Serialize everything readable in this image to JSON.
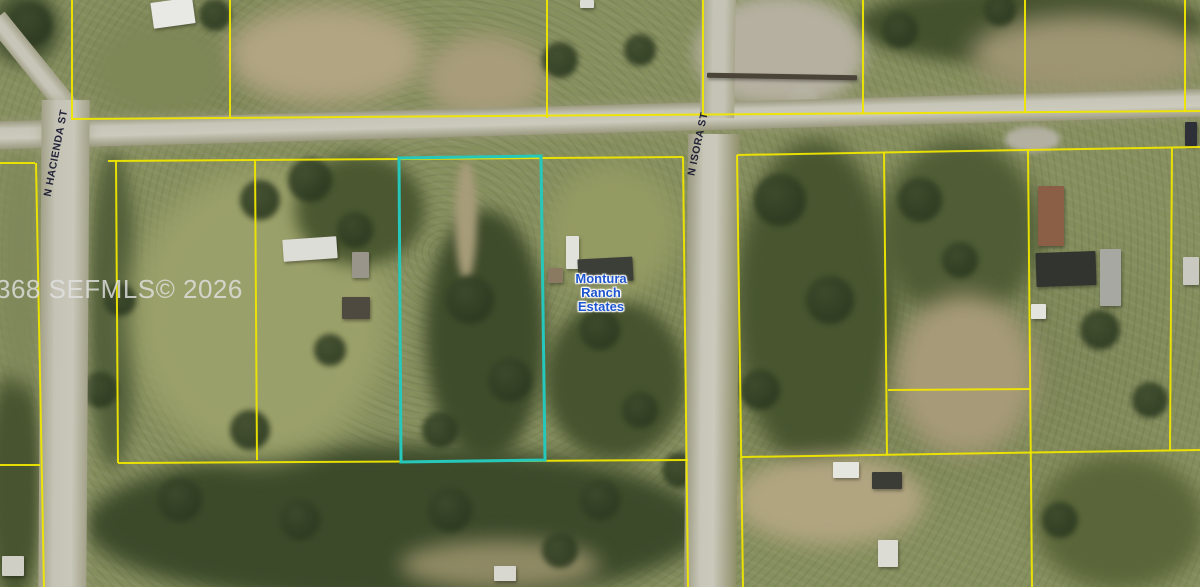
{
  "watermark": {
    "text": "368 SEFMLS© 2026"
  },
  "streets": {
    "hacienda": "N HACIENDA ST",
    "isora": "N ISORA ST"
  },
  "area_label": {
    "lines": [
      "Montura",
      "Ranch",
      "Estates"
    ]
  },
  "colors": {
    "parcel_line": "#f0e600",
    "highlight_parcel": "#25c8ba",
    "area_label_blue": "#1d55cf",
    "street_label": "#14142e",
    "watermark_gray": "#e2e2e2",
    "road_gray": "#c2c1b3",
    "vegetation_base": "#868f5e"
  }
}
